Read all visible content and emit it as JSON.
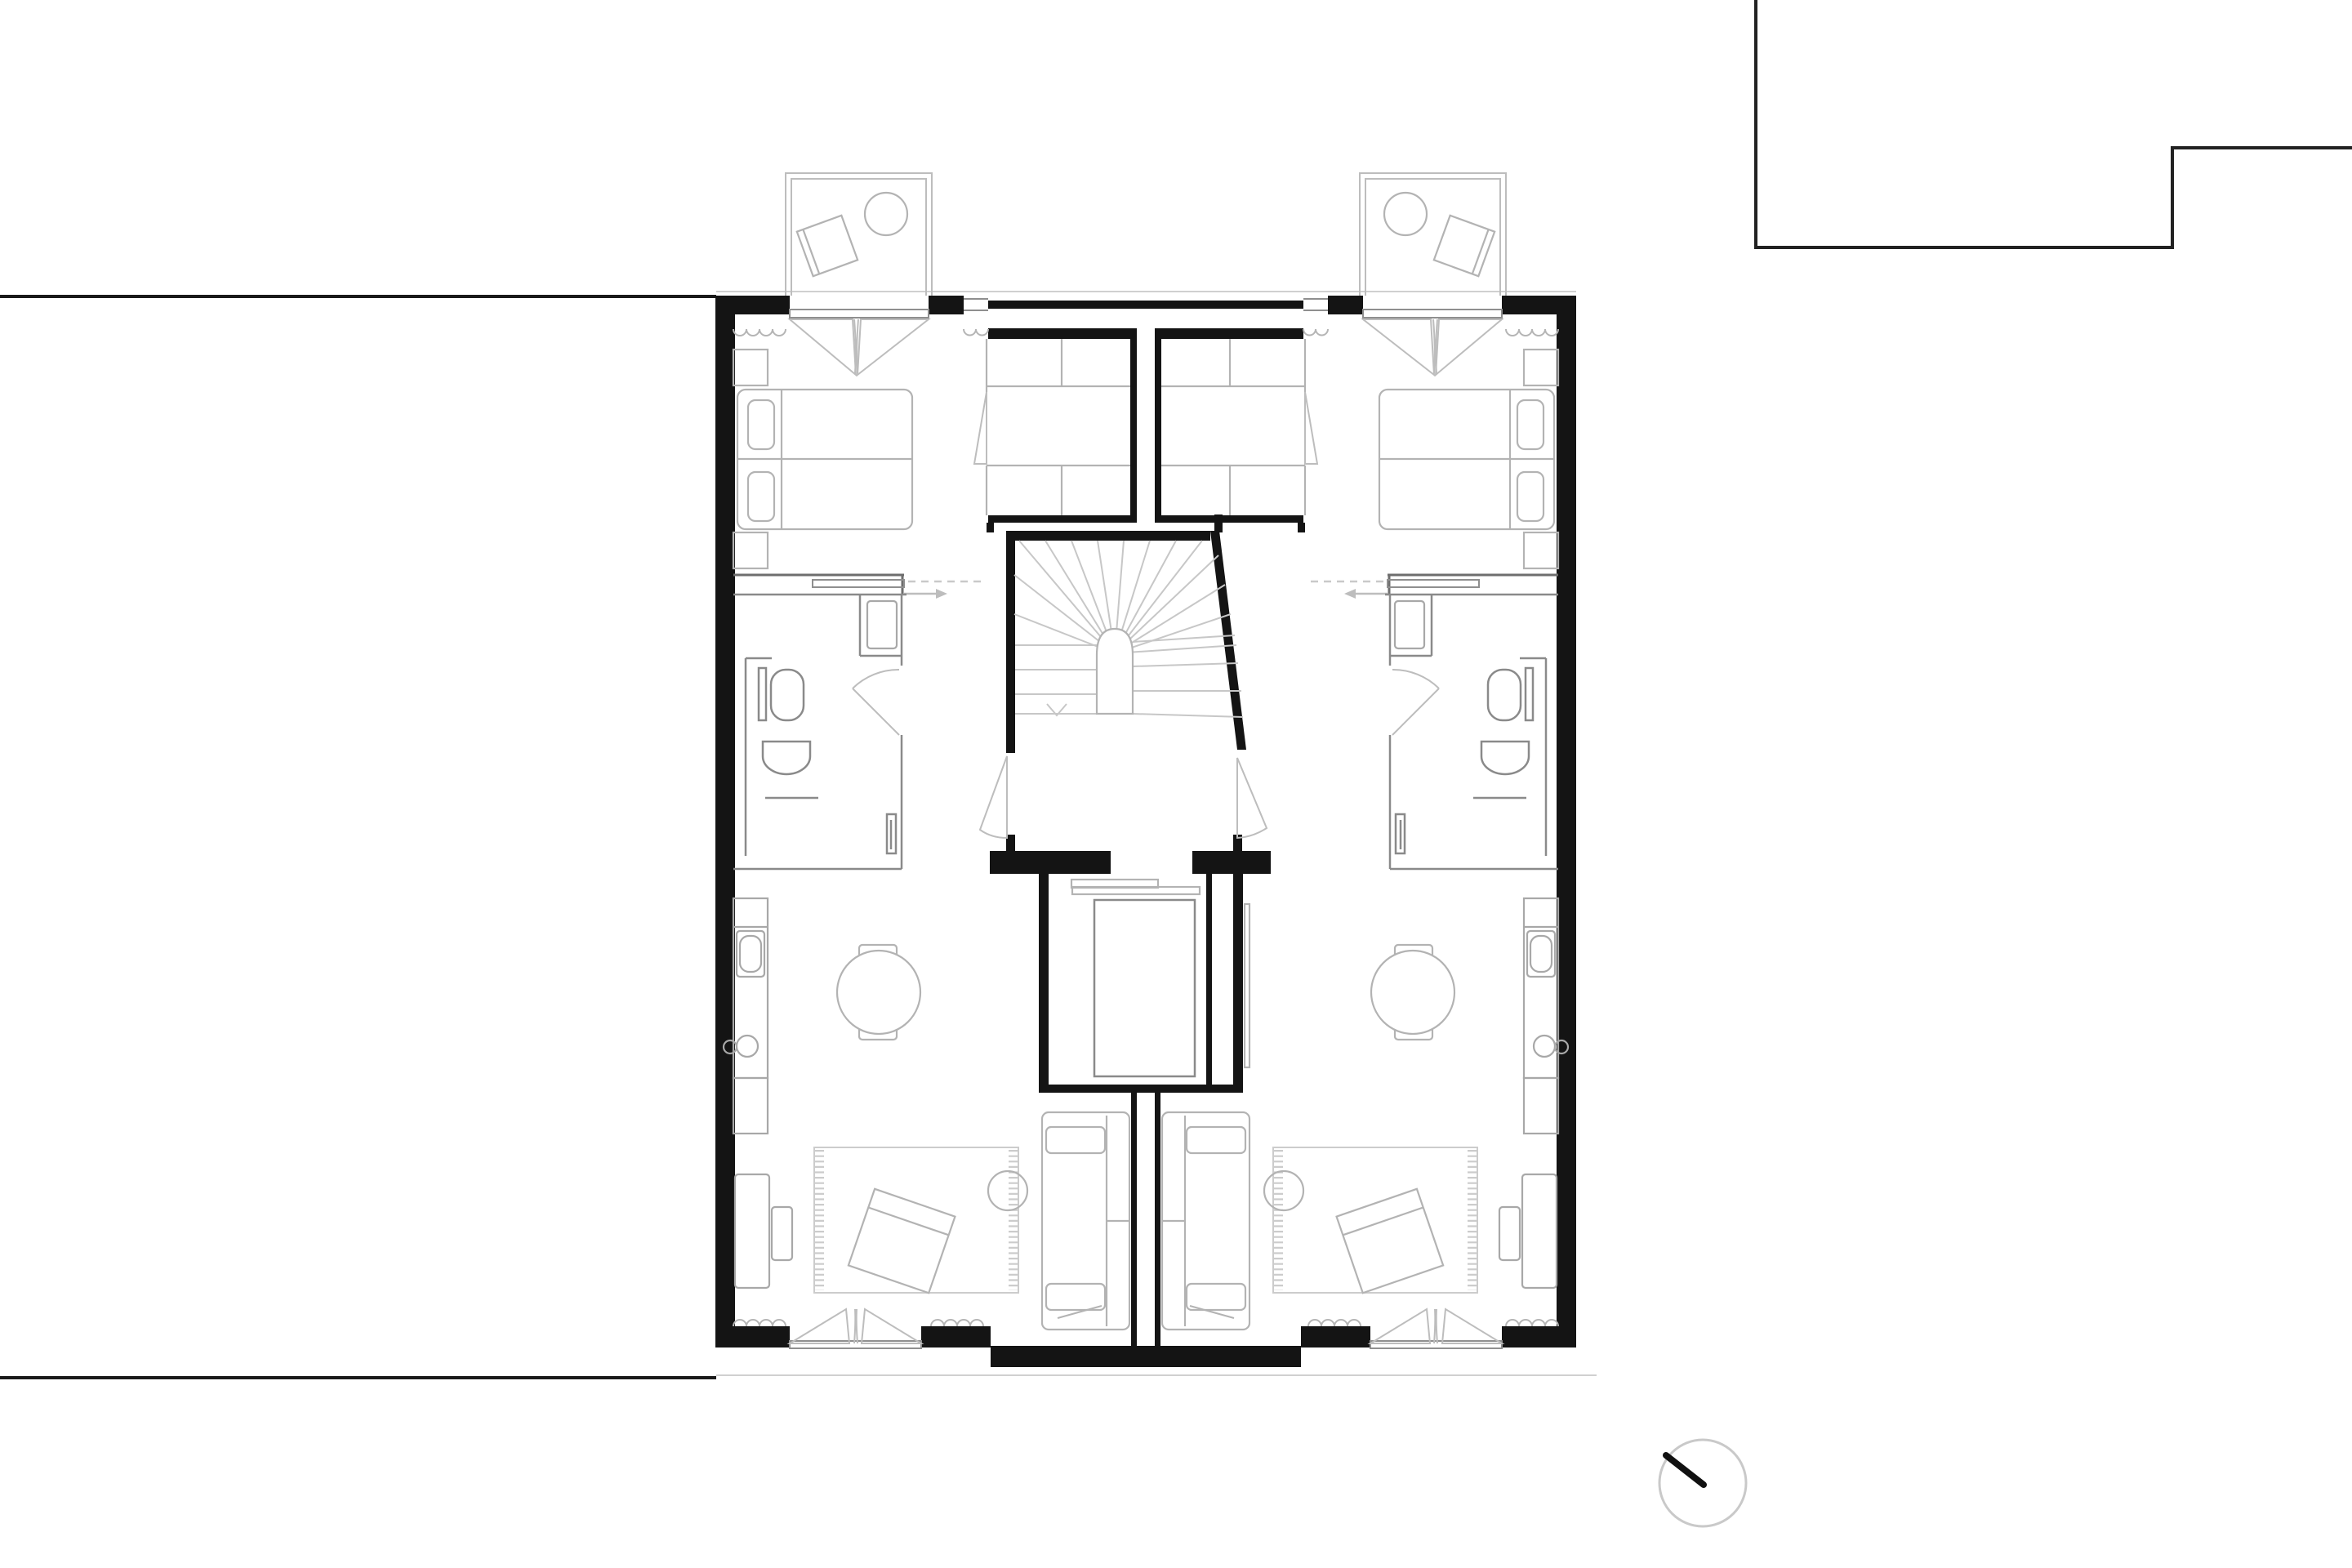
{
  "document": {
    "description": "Black-and-white architectural floor plan of two mirrored apartment units arranged around a shared central winder staircase and light well, with two balconies on the top facade, a north arrow at bottom right and neighbouring site boundary lines.",
    "drawing_type": "floor plan",
    "visible_text": []
  },
  "colors": {
    "paper": "#ffffff",
    "wall": "#141414",
    "site_line": "#1a1a1a",
    "neighbour_line": "#222222",
    "partition": "#8a8a8a",
    "hall_wall": "#6e6e6e",
    "furniture": "#b3b3b3",
    "kitchen": "#a8a8a8",
    "door_swing": "#bdbdbd",
    "window_scallop": "#b5b5b5",
    "sill": "#8f8f8f",
    "tread": "#c7c7c7",
    "rug": "#cccccc",
    "guide_dash": "#c9c9c9",
    "eave": "#d0d0d0",
    "compass_ring": "#c9c9c9",
    "needle": "#111111"
  },
  "site": {
    "boundary_lines": [
      "west boundary line upper",
      "west boundary line lower"
    ],
    "neighbour_outline": "stepped outline of adjacent building at top right",
    "eave_line": "thin roof overhang line along top facade",
    "terrace_edge": "thin ground line along bottom facade"
  },
  "compass": {
    "symbol": "north-arrow",
    "points_to": "upper-left (north-west)"
  },
  "stair_core": {
    "type": "winder staircase with arched central newel",
    "treads_fanning": 15,
    "direction_mark": "chevron",
    "doors": [
      "door to left unit",
      "door to right unit"
    ],
    "light_well": {
      "void": "rectangular floor opening",
      "shelves": 2,
      "door_leaf": 1
    }
  },
  "units": [
    {
      "id": "left-unit",
      "rooms": [
        {
          "name": "bedroom",
          "furniture": [
            "double bed with two pillows",
            "nightstand",
            "nightstand",
            "built-in closet with swing door"
          ]
        },
        {
          "name": "balcony",
          "furniture": [
            "round table",
            "lounge chair"
          ],
          "openings": [
            "french door with curtain scallops"
          ]
        },
        {
          "name": "hallway",
          "features": [
            "sliding door",
            "entry direction arrow (dashed)"
          ]
        },
        {
          "name": "bathroom",
          "fixtures": [
            "toilet",
            "wash basin",
            "shower",
            "radiator",
            "hinged door"
          ]
        },
        {
          "name": "kitchen",
          "fixtures": [
            "counter",
            "cooktop appliance",
            "sink with faucet"
          ]
        },
        {
          "name": "dining",
          "furniture": [
            "round table",
            "chair",
            "chair"
          ]
        },
        {
          "name": "living room",
          "furniture": [
            "sofa with cushions",
            "rug with fringes",
            "ottoman",
            "floor lamp",
            "armchair",
            "footstool"
          ],
          "openings": [
            "french door to garden with curtain scallops"
          ]
        }
      ]
    },
    {
      "id": "right-unit",
      "mirror_of": "left-unit"
    }
  ]
}
